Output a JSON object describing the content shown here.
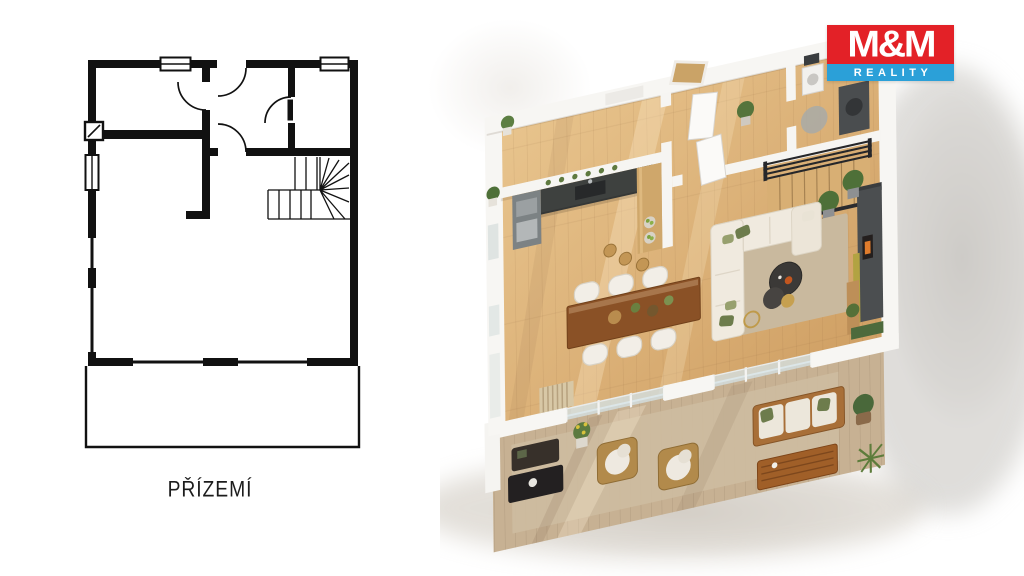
{
  "floor_plan": {
    "label": "PŘÍZEMÍ",
    "ink": "#111111",
    "paper": "#ffffff",
    "features": [
      "outer walls",
      "windows",
      "door swings",
      "winder staircase",
      "chimney flue",
      "terrace outline"
    ]
  },
  "logo": {
    "line1": "M&M",
    "line2": "REALITY",
    "red": "#e32127",
    "blue": "#2ba0d8",
    "text_color": "#ffffff"
  },
  "palette": {
    "background": "#ffffff",
    "wood_floor": "#d6ab70",
    "wood_floor_light": "#e8c48d",
    "wall_white": "#f7f6f3",
    "kitchen_counter_dark": "#3e413f",
    "tv_wall_charcoal": "#4b4e50",
    "sofa_cream": "#f0eadf",
    "pillow_olive": "#6d7c4c",
    "rug_beige": "#c9b99e",
    "terrace_deck": "#c7b193",
    "dining_table_wood": "#8a5126",
    "outdoor_wood": "#a86f38",
    "plant_green": "#4e7038",
    "accent_lime": "#b2a342",
    "railing_black": "#26272a",
    "fireplace_flame": "#e07c2c"
  },
  "render": {
    "type": "3d-floor-plan-visualization",
    "rooms": [
      "kitchen",
      "entry hall",
      "bathroom",
      "staircase",
      "dining area",
      "living room",
      "terrace"
    ],
    "furniture": [
      "kitchen counter with sink",
      "wood bar with fruit bowls and stools",
      "shelf with small plants",
      "white interior doors",
      "washing machine",
      "dark vanity with basin",
      "wood staircase with black railing",
      "dining table with six white chairs",
      "white corner sofa with olive pillows",
      "round dark coffee tables",
      "gold side table",
      "charcoal tv wall with fireplace",
      "wood console with plant",
      "vertical garden strip",
      "slatted privacy screen",
      "dark outdoor lounge set",
      "two wicker armchairs with white cushions",
      "outdoor wood sofa with white cushions and green pillows",
      "slatted outdoor coffee table",
      "potted plants",
      "yucca plant"
    ]
  }
}
